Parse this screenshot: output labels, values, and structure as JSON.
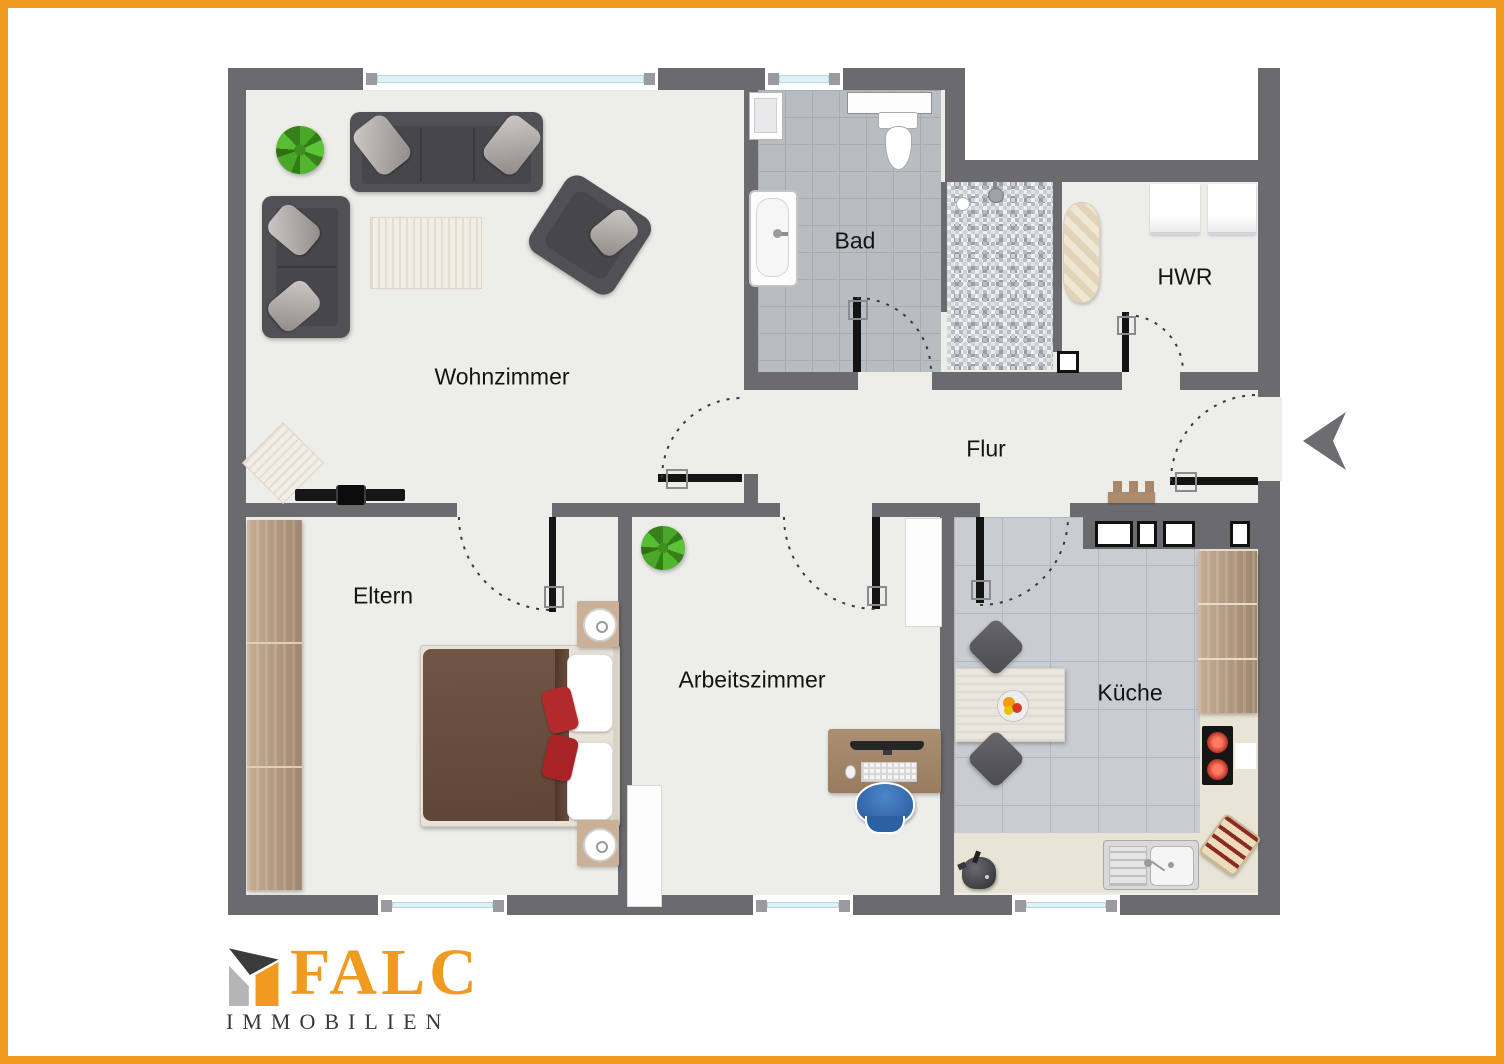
{
  "plan": {
    "rooms": [
      {
        "id": "wohnzimmer",
        "label": "Wohnzimmer"
      },
      {
        "id": "bad",
        "label": "Bad"
      },
      {
        "id": "hwr",
        "label": "HWR"
      },
      {
        "id": "flur",
        "label": "Flur"
      },
      {
        "id": "eltern",
        "label": "Eltern"
      },
      {
        "id": "arbeitszimmer",
        "label": "Arbeitszimmer"
      },
      {
        "id": "kueche",
        "label": "Küche"
      }
    ]
  },
  "logo": {
    "brand": "FALC",
    "subtitle": "IMMOBILIEN"
  },
  "colors": {
    "accent_orange": "#EE9B1F",
    "wall_gray": "#6B6B6F",
    "floor": "#EDEEEA",
    "bad_tile": "#B8BDC2",
    "kitchen_tile": "#C9CDD2",
    "counter_beige": "#E9E5D6",
    "logo_text_gray": "#3A3A3C"
  }
}
